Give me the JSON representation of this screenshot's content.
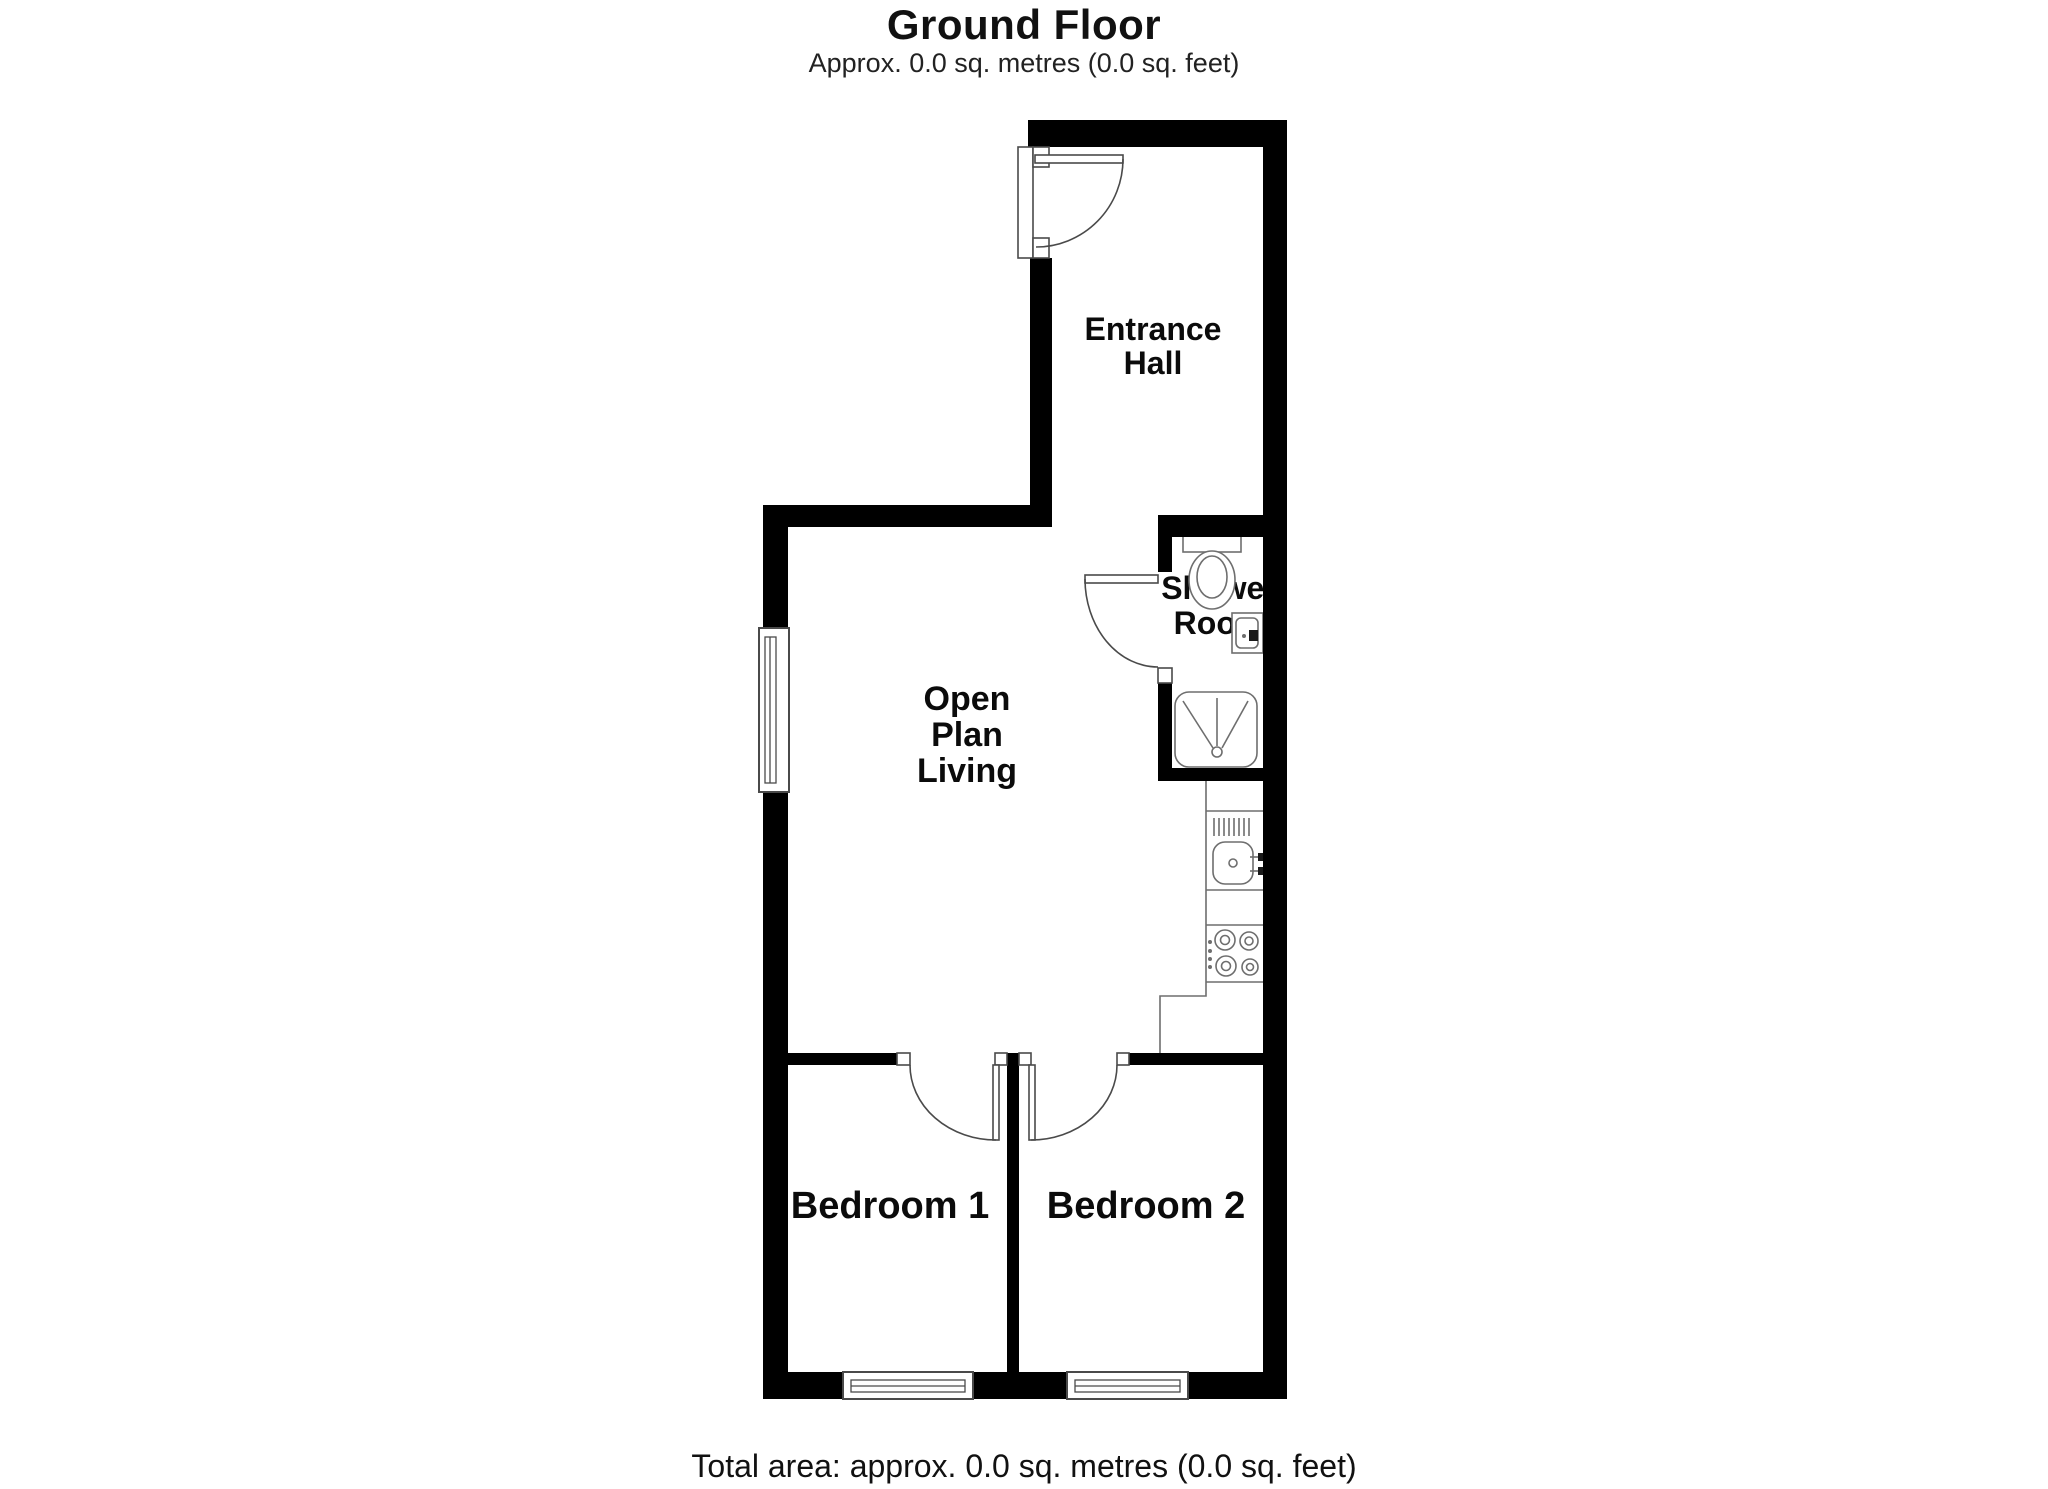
{
  "page": {
    "title": "Ground Floor",
    "subtitle": "Approx. 0.0 sq. metres (0.0 sq. feet)",
    "total_area": "Total area: approx. 0.0 sq. metres (0.0 sq. feet)"
  },
  "rooms": {
    "entrance_hall": {
      "line1": "Entrance",
      "line2": "Hall"
    },
    "shower_room": {
      "line1": "Shower",
      "line2": "Room"
    },
    "open_plan_living": {
      "line1": "Open",
      "line2": "Plan",
      "line3": "Living"
    },
    "bedroom_1": {
      "label": "Bedroom 1"
    },
    "bedroom_2": {
      "label": "Bedroom 2"
    }
  },
  "fixtures": {
    "toilet": "toilet-icon",
    "bathroom_sink": "bathroom-sink-icon",
    "shower_tray": "shower-tray-icon",
    "kitchen_sink": "kitchen-sink-icon",
    "hob": "hob-icon",
    "kitchen_counter": "kitchen-counter-outline"
  },
  "colors": {
    "wall": "#000000",
    "background": "#ffffff",
    "fixture_line": "#6e6e6e",
    "door_line": "#4a4a4a"
  }
}
